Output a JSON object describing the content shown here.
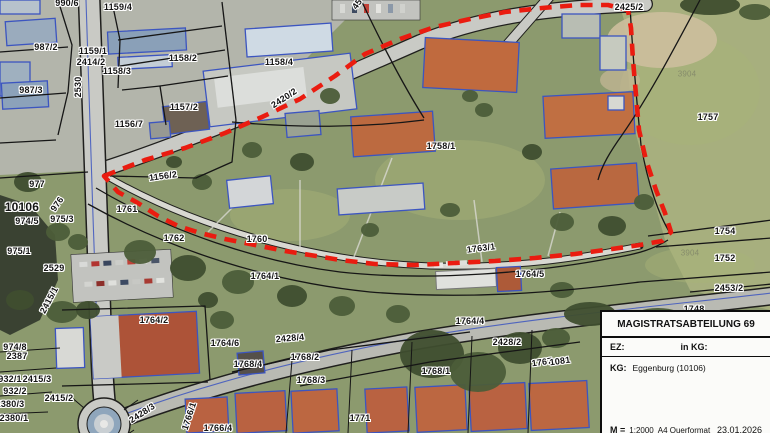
{
  "colors": {
    "boundary_red": "#ea1c10",
    "survey_blue": "#3c55c0",
    "label_text": "#141414"
  },
  "map": {
    "labels": [
      {
        "text": "990/6",
        "x": 67,
        "y": 3
      },
      {
        "text": "1159/4",
        "x": 118,
        "y": 7
      },
      {
        "text": "987/2",
        "x": 46,
        "y": 47
      },
      {
        "text": "1159/1",
        "x": 93,
        "y": 51
      },
      {
        "text": "2414/2",
        "x": 91,
        "y": 62
      },
      {
        "text": "1158/2",
        "x": 183,
        "y": 58
      },
      {
        "text": "1158/3",
        "x": 117,
        "y": 71
      },
      {
        "text": "987/3",
        "x": 31,
        "y": 90
      },
      {
        "text": "2530",
        "x": 78,
        "y": 87,
        "rot": -90
      },
      {
        "text": "1157/2",
        "x": 184,
        "y": 107
      },
      {
        "text": "1156/7",
        "x": 129,
        "y": 124
      },
      {
        "text": "1158/4",
        "x": 279,
        "y": 62
      },
      {
        "text": "2420/2",
        "x": 284,
        "y": 98,
        "rot": -33
      },
      {
        "text": "45",
        "x": 357,
        "y": 4,
        "rot": -55
      },
      {
        "text": "2425/2",
        "x": 629,
        "y": 7
      },
      {
        "text": "3904",
        "x": 687,
        "y": 74,
        "cls": "faint"
      },
      {
        "text": "1757",
        "x": 708,
        "y": 117
      },
      {
        "text": "1758/1",
        "x": 441,
        "y": 146
      },
      {
        "text": "1156/2",
        "x": 163,
        "y": 176,
        "rot": -8
      },
      {
        "text": "977",
        "x": 37,
        "y": 184
      },
      {
        "text": "10106",
        "x": 22,
        "y": 207,
        "cls": "big"
      },
      {
        "text": "976",
        "x": 57,
        "y": 204,
        "rot": -55
      },
      {
        "text": "974/5",
        "x": 27,
        "y": 221
      },
      {
        "text": "975/3",
        "x": 62,
        "y": 219
      },
      {
        "text": "975/1",
        "x": 19,
        "y": 251
      },
      {
        "text": "2529",
        "x": 54,
        "y": 268
      },
      {
        "text": "1761",
        "x": 127,
        "y": 209
      },
      {
        "text": "1762",
        "x": 174,
        "y": 238
      },
      {
        "text": "1760",
        "x": 257,
        "y": 239
      },
      {
        "text": "1764/1",
        "x": 265,
        "y": 276
      },
      {
        "text": "1763/1",
        "x": 481,
        "y": 248,
        "rot": -7
      },
      {
        "text": "1764/5",
        "x": 530,
        "y": 274
      },
      {
        "text": "1754",
        "x": 725,
        "y": 231
      },
      {
        "text": "1752",
        "x": 725,
        "y": 258
      },
      {
        "text": "2453/2",
        "x": 729,
        "y": 288
      },
      {
        "text": "3904",
        "x": 690,
        "y": 253,
        "cls": "faint"
      },
      {
        "text": "1748",
        "x": 694,
        "y": 309
      },
      {
        "text": "2415/1",
        "x": 49,
        "y": 300,
        "rot": -62
      },
      {
        "text": "1764/2",
        "x": 154,
        "y": 320
      },
      {
        "text": "974/8",
        "x": 15,
        "y": 347
      },
      {
        "text": "2387",
        "x": 17,
        "y": 356
      },
      {
        "text": "932/1",
        "x": 10,
        "y": 379
      },
      {
        "text": "2415/3",
        "x": 37,
        "y": 379
      },
      {
        "text": "932/2",
        "x": 15,
        "y": 391
      },
      {
        "text": "2380/3",
        "x": 10,
        "y": 404
      },
      {
        "text": "2380/1",
        "x": 14,
        "y": 418
      },
      {
        "text": "2415/2",
        "x": 59,
        "y": 398
      },
      {
        "text": "2428/3",
        "x": 142,
        "y": 413,
        "rot": -33
      },
      {
        "text": "1766/1",
        "x": 189,
        "y": 416,
        "rot": -72
      },
      {
        "text": "1766/4",
        "x": 218,
        "y": 428
      },
      {
        "text": "1771",
        "x": 360,
        "y": 418
      },
      {
        "text": "1764/6",
        "x": 225,
        "y": 343
      },
      {
        "text": "2428/4",
        "x": 290,
        "y": 338,
        "rot": -5
      },
      {
        "text": "1768/2",
        "x": 305,
        "y": 357
      },
      {
        "text": "1768/4",
        "x": 248,
        "y": 364
      },
      {
        "text": "1768/3",
        "x": 311,
        "y": 380
      },
      {
        "text": "1764/4",
        "x": 470,
        "y": 321
      },
      {
        "text": "2428/2",
        "x": 507,
        "y": 342
      },
      {
        "text": "1767",
        "x": 542,
        "y": 362,
        "rot": -8
      },
      {
        "text": "1081",
        "x": 560,
        "y": 361,
        "rot": -8
      },
      {
        "text": "1768/1",
        "x": 436,
        "y": 371
      }
    ]
  },
  "infobox": {
    "title": "MAGISTRATSABTEILUNG 69",
    "ez_label": "EZ:",
    "in_kg_label": "in KG:",
    "kg_label": "KG:",
    "kg_value": "Eggenburg (10106)",
    "scale_label": "M =",
    "scale_value": "1:2000",
    "format_value": "A4 Querformat",
    "date": "23.01.2026"
  }
}
